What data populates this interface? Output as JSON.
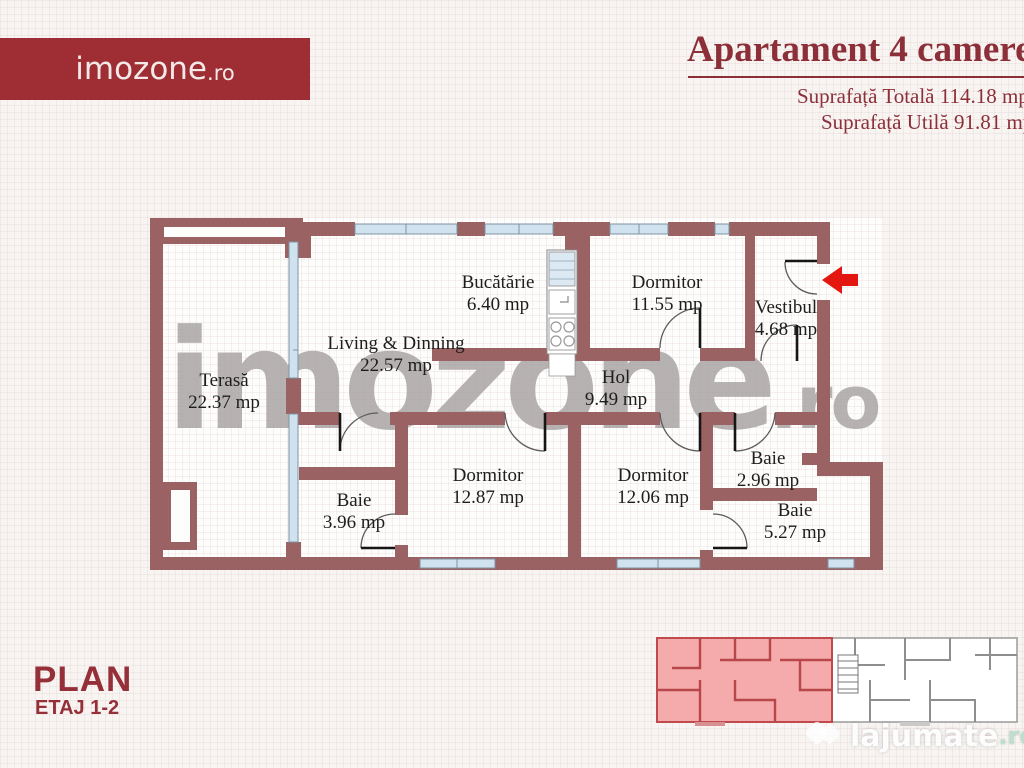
{
  "header": {
    "logo": {
      "name": "imozone",
      "tld": ".ro"
    },
    "title": "Apartament 4 camere",
    "area_total": "Suprafață Totală 114.18 mp",
    "area_utila": "Suprafață Utilă 91.81 mp"
  },
  "plan": {
    "rooms": [
      {
        "name": "Terasă",
        "area": "22.37 mp"
      },
      {
        "name": "Living & Dinning",
        "area": "22.57 mp"
      },
      {
        "name": "Bucătărie",
        "area": "6.40 mp"
      },
      {
        "name": "Dormitor",
        "area": "11.55 mp"
      },
      {
        "name": "Vestibul",
        "area": "4.68 mp"
      },
      {
        "name": "Hol",
        "area": "9.49 mp"
      },
      {
        "name": "Dormitor",
        "area": "12.87 mp"
      },
      {
        "name": "Dormitor",
        "area": "12.06 mp"
      },
      {
        "name": "Baie",
        "area": "3.96 mp"
      },
      {
        "name": "Baie",
        "area": "2.96 mp"
      },
      {
        "name": "Baie",
        "area": "5.27 mp"
      }
    ],
    "colors": {
      "wall": "#9a6263",
      "window": "#cfe2ee",
      "entrance_arrow": "#e3170f",
      "minimap_highlight": "#f5abab"
    }
  },
  "watermark": {
    "name": "imozone",
    "tld": ".ro"
  },
  "footer": {
    "plan_label": "PLAN",
    "floor_label": "ETAJ 1-2"
  },
  "branding": {
    "site": "lajumate",
    "tld": ".ro"
  }
}
